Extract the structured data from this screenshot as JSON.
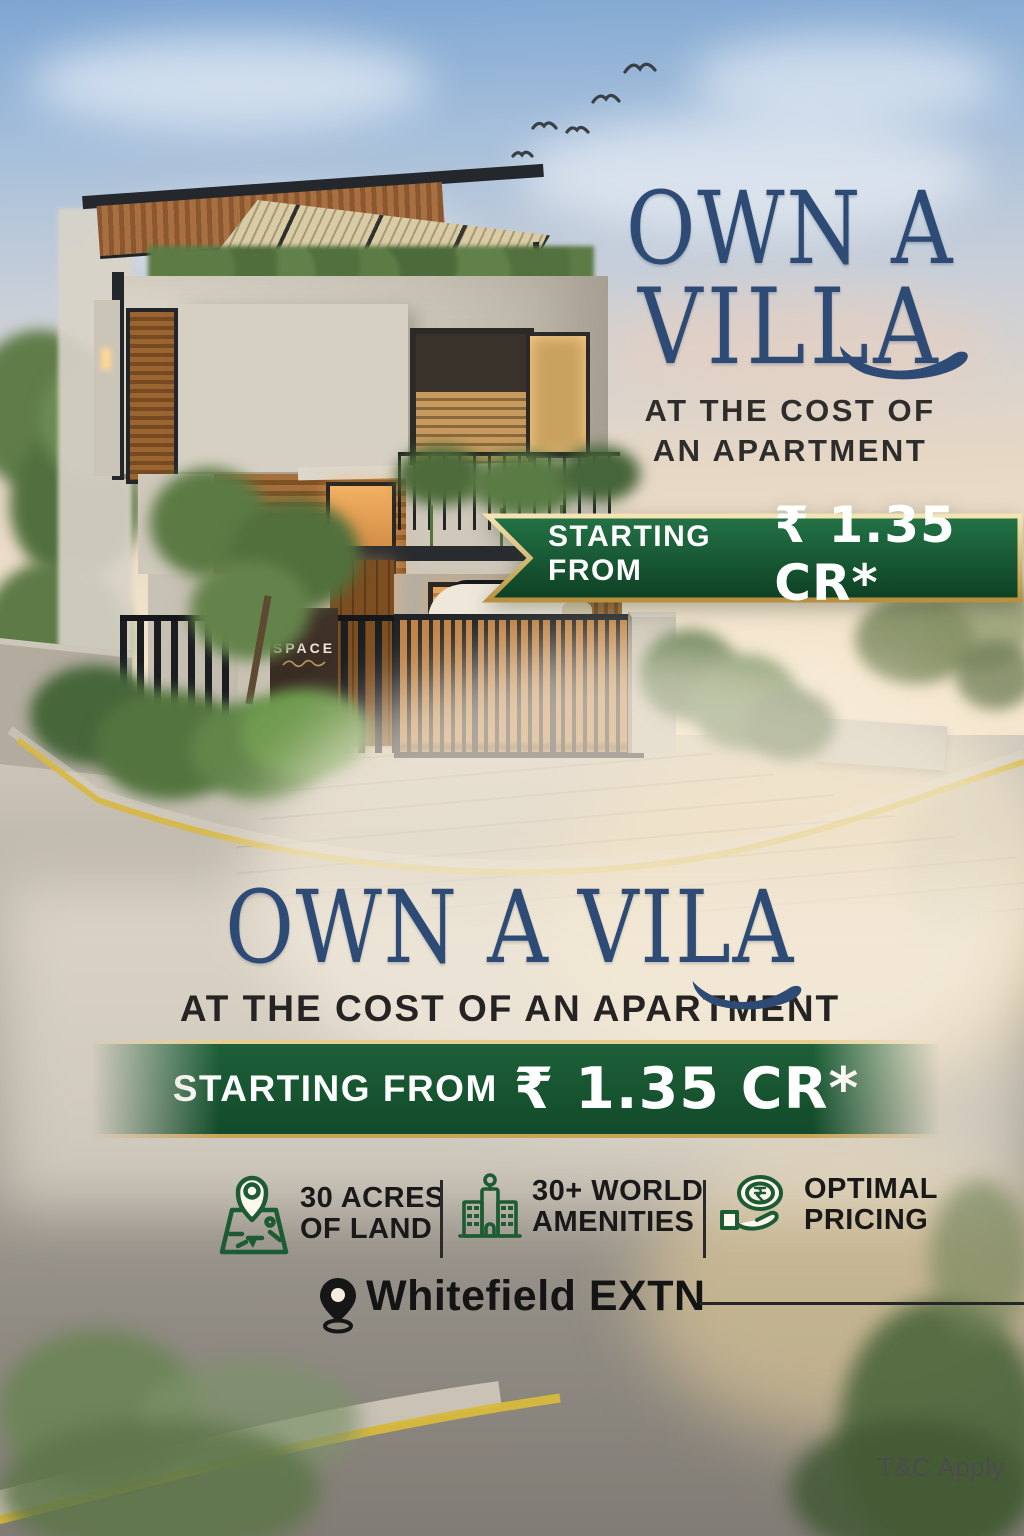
{
  "poster": {
    "headline_top": {
      "line1": "OWN A",
      "line2": "VILLA",
      "subline1": "AT THE COST OF",
      "subline2": "AN APARTMENT"
    },
    "price_banner_top": {
      "prefix": "STARTING FROM",
      "amount": "₹ 1.35 CR*"
    },
    "headline_mid": {
      "title": "OWN A VILA",
      "subtitle": "AT THE COST OF AN APARTMENT"
    },
    "price_banner_mid": {
      "prefix": "STARTING FROM",
      "amount": "₹ 1.35 CR*"
    },
    "features": [
      {
        "icon": "map-acres-icon",
        "line1": "30 ACRES",
        "line2": "OF LAND"
      },
      {
        "icon": "amenities-building-icon",
        "line1": "30+ WORLD",
        "line2": "AMENITIES"
      },
      {
        "icon": "hand-coin-icon",
        "line1": "OPTIMAL",
        "line2": "PRICING"
      }
    ],
    "location": {
      "label": "Whitefield EXTN"
    },
    "disclaimer": "T&C Apply",
    "building_sign": {
      "main": "SPACE",
      "partial": "ACS"
    },
    "colors": {
      "headline_navy": "#2d4b74",
      "banner_green_dark": "#0d3f23",
      "banner_green_light": "#237346",
      "banner_gold": "#e0c27a",
      "icon_green": "#1d5c33",
      "road_yellow": "#d8b93c",
      "text_dark": "#1c1c1c"
    }
  }
}
